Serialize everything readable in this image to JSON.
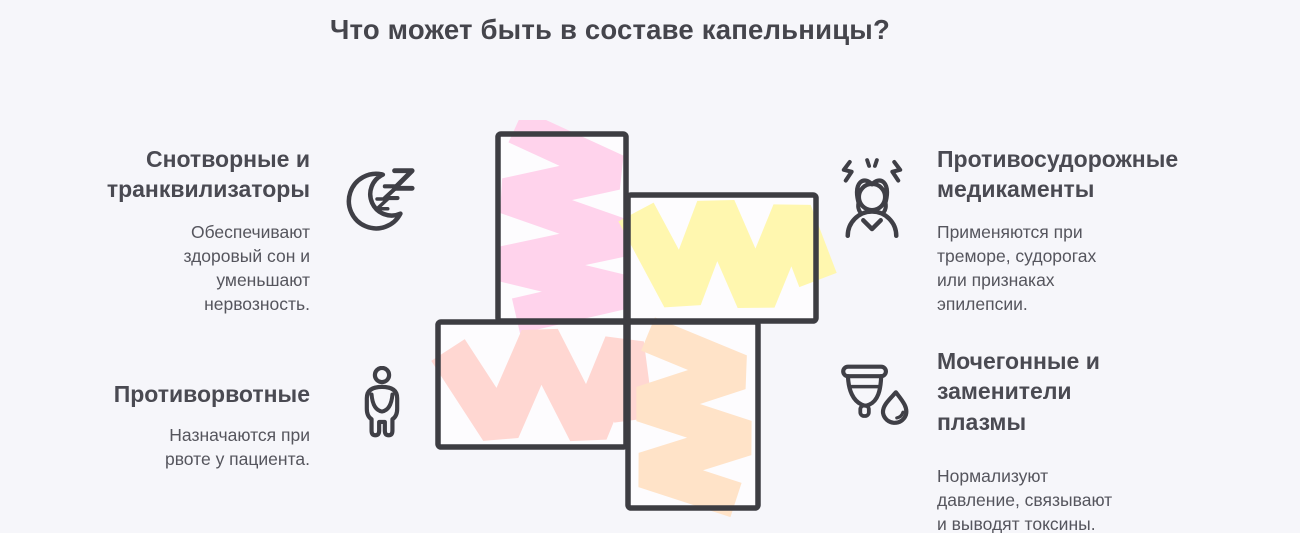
{
  "title": "Что может быть в составе капельницы?",
  "sections": [
    {
      "id": "sedatives",
      "heading": "Снотворные и\nтранквилизаторы",
      "description": "Обеспечивают\nздоровый сон и\nуменьшают\nнервозность.",
      "icon": "sleep-moon-icon",
      "color": "#ffd3ec"
    },
    {
      "id": "anticonvulsants",
      "heading": "Противосудорожные\nмедикаменты",
      "description": "Применяются при\nтреморе, судорогах\nили признаках\nэпилепсии.",
      "icon": "stressed-person-icon",
      "color": "#fff7af"
    },
    {
      "id": "antiemetics",
      "heading": "Противорвотные",
      "description": "Назначаются при\nрвоте у пациента.",
      "icon": "nausea-person-icon",
      "color": "#ffd7d2"
    },
    {
      "id": "diuretics",
      "heading": "Мочегонные и\nзаменители\nплазмы",
      "description": "Нормализуют\nдавление, связывают\nи выводят токсины.",
      "icon": "cup-drop-icon",
      "color": "#ffe3c8"
    }
  ],
  "colors": {
    "background": "#f6f6fa",
    "panel_fill": "#fdfcfe",
    "outline": "#3d3d42",
    "icon": "#3f3f46",
    "title_text": "#45454c",
    "heading_text": "#4a4a52",
    "body_text": "#55555d",
    "footer_bar": "#ffffff"
  }
}
